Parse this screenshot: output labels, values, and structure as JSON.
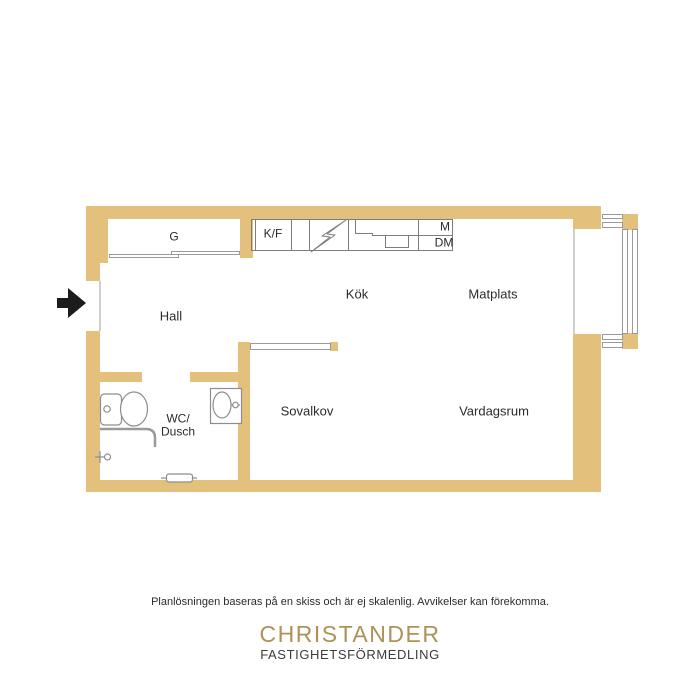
{
  "floor_plan": {
    "labels": {
      "g": "G",
      "kf": "K/F",
      "m": "M",
      "dm": "DM",
      "kok": "Kök",
      "matplats": "Matplats",
      "hall": "Hall",
      "wc1": "WC/",
      "wc2": "Dusch",
      "sovalkov": "Sovalkov",
      "vardagsrum": "Vardagsrum"
    },
    "icons": {
      "stove": "lightning-bolt-icon",
      "entrance": "entrance-arrow-icon",
      "toilet": "toilet-icon",
      "washbasin": "sink-icon",
      "shower": "shower-icon",
      "radiator": "radiator-icon",
      "wardrobe_doors": "sliding-door-icon",
      "bay": "window-icon"
    },
    "colors": {
      "wall": "#e3c17d",
      "fixture_line": "#7d7d7d",
      "ink": "#2b2b2b",
      "arrow": "#1c1c1c"
    }
  },
  "footer": {
    "disclaimer": "Planlösningen baseras på en skiss och är ej skalenlig. Avvikelser kan förekomma.",
    "brand_name": "CHRISTANDER",
    "brand_subtitle": "FASTIGHETSFÖRMEDLING",
    "brand_color": "#ae9257"
  }
}
